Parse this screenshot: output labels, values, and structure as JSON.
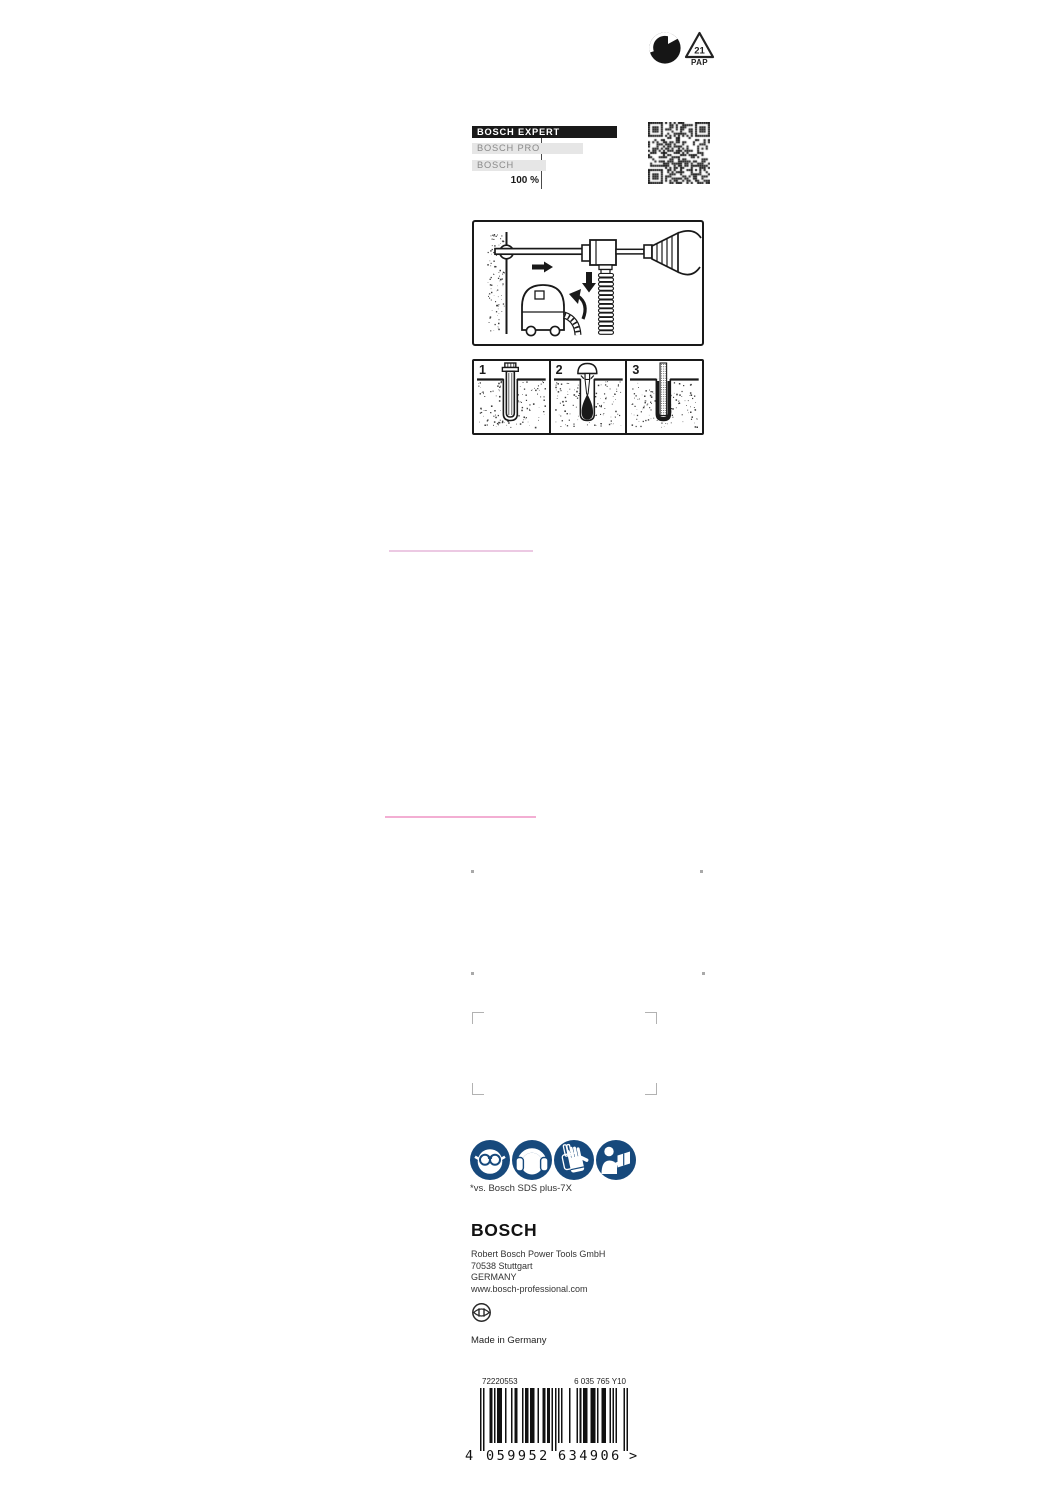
{
  "colors": {
    "ink": "#191919",
    "safety_blue": "#17497C",
    "tier_bar_gray": "#e6e6e6",
    "tier_text_gray": "#8a8a8a",
    "die_line_pink_top": "#ecc9e3",
    "die_line_pink_bottom": "#f3aed3",
    "print_mark_gray": "#b2b2b2"
  },
  "recycling": {
    "icons": [
      "green-dot-icon",
      "pap-21-recycling-icon"
    ],
    "pap_number": "21",
    "pap_label": "PAP"
  },
  "tier_chart": {
    "type": "bar",
    "reference_label": "100 %",
    "items": [
      {
        "label": "BOSCH EXPERT",
        "tier": "expert",
        "width_px": 140
      },
      {
        "label": "BOSCH PRO",
        "tier": "pro",
        "width_px": 106
      },
      {
        "label": "BOSCH",
        "tier": "standard",
        "width_px": 69
      }
    ]
  },
  "steps": [
    {
      "number": "1",
      "description": "drill-hole-with-anchor"
    },
    {
      "number": "2",
      "description": "blow-out-dust"
    },
    {
      "number": "3",
      "description": "set-anchor-rod"
    }
  ],
  "safety_icons": [
    {
      "name": "wear-eye-protection"
    },
    {
      "name": "wear-ear-protection"
    },
    {
      "name": "wear-gloves"
    },
    {
      "name": "read-instruction-manual"
    }
  ],
  "footnote": "*vs. Bosch SDS plus-7X",
  "footer": {
    "logo": "BOSCH",
    "address_lines": [
      "Robert Bosch Power Tools GmbH",
      "70538 Stuttgart",
      "GERMANY",
      "www.bosch-professional.com"
    ],
    "made_in": "Made in Germany"
  },
  "barcode": {
    "article_number": "72220553",
    "type_number": "6 035 765 Y10",
    "ean": "4059952634906",
    "human_readable": {
      "lead": "4",
      "group1": "059952",
      "group2": "634906",
      "suffix": ">"
    }
  }
}
